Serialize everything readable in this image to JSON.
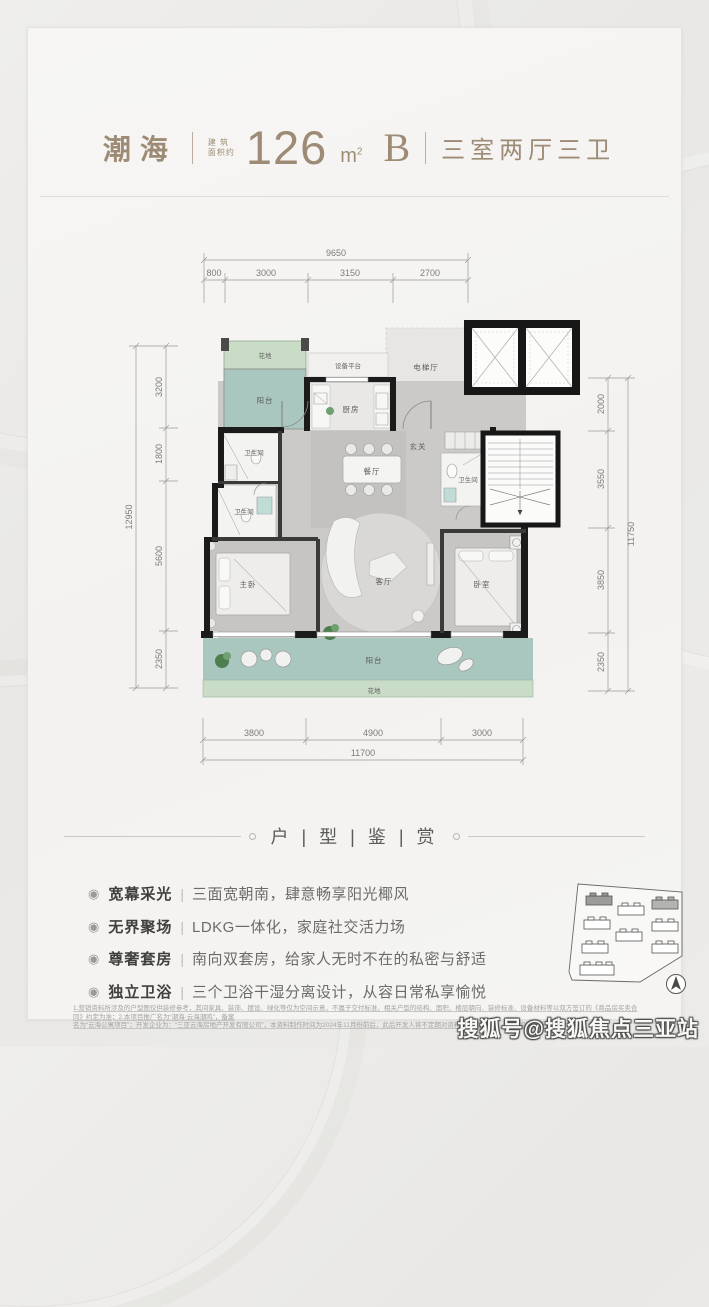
{
  "header": {
    "project_name": "潮海",
    "area_label_line1": "建 筑",
    "area_label_line2": "面积约",
    "area_number": "126",
    "area_unit": "m",
    "area_sup": "2",
    "unit_code": "B",
    "rooms_desc": "三室两厅三卫"
  },
  "plan": {
    "dims_top": {
      "total": "9650",
      "segments": [
        "800",
        "3000",
        "3150",
        "2700"
      ]
    },
    "dims_left": {
      "total": "12950",
      "segments": [
        "3200",
        "1800",
        "5600",
        "2350"
      ]
    },
    "dims_right": {
      "total": "11750",
      "segments": [
        "2000",
        "3550",
        "3850",
        "2350"
      ]
    },
    "dims_bottom": {
      "total": "11700",
      "segments": [
        "3800",
        "4900",
        "3000"
      ]
    },
    "rooms": {
      "flowerbed_top": "花地",
      "balcony_top": "阳台",
      "equipment_platform": "设备平台",
      "kitchen": "厨房",
      "elevator_hall": "电梯厅",
      "bathroom_1": "卫生间",
      "bathroom_2": "卫生间",
      "bathroom_3": "卫生间",
      "foyer": "玄关",
      "dining": "餐厅",
      "master_bedroom": "主卧",
      "living": "客厅",
      "bedroom_2": "卧室",
      "balcony_bottom": "阳台",
      "flowerbed_bottom": "花地"
    }
  },
  "section": {
    "title": "户 | 型 | 鉴 | 赏"
  },
  "features_meta": {
    "bullet": "◉",
    "sep": "|"
  },
  "features": [
    {
      "label": "宽幕采光",
      "desc": "三面宽朝南，肆意畅享阳光椰风"
    },
    {
      "label": "无界聚场",
      "desc": "LDKG一体化，家庭社交活力场"
    },
    {
      "label": "尊奢套房",
      "desc": "南向双套房，给家人无时不在的私密与舒适"
    },
    {
      "label": "独立卫浴",
      "desc": "三个卫浴干湿分离设计，从容日常私享愉悦"
    }
  ],
  "disclaimer": {
    "line1": "1.营销资料所涉及的户型图仅供装修参考，其间家具、装饰、摆设、绿化等仅为空间示意，不属于交付标准，相关户型的结构、面积、楼层朝向、装修标准、设备材料等以双方签订的《商品房买卖合同》约定为准；2.本项目推广名为“潮海·云海潮鸣”，备案",
    "line2": "名为“云海公寓项目”；开发企业为：“三亚云海房地产开发有限公司”，本资料制作时间为2024年11月份前后，此后开发人将不定期对资料进行相应修改，敬请留意最新资料。"
  },
  "watermark": {
    "text": "搜狐号@搜狐焦点三亚站"
  }
}
